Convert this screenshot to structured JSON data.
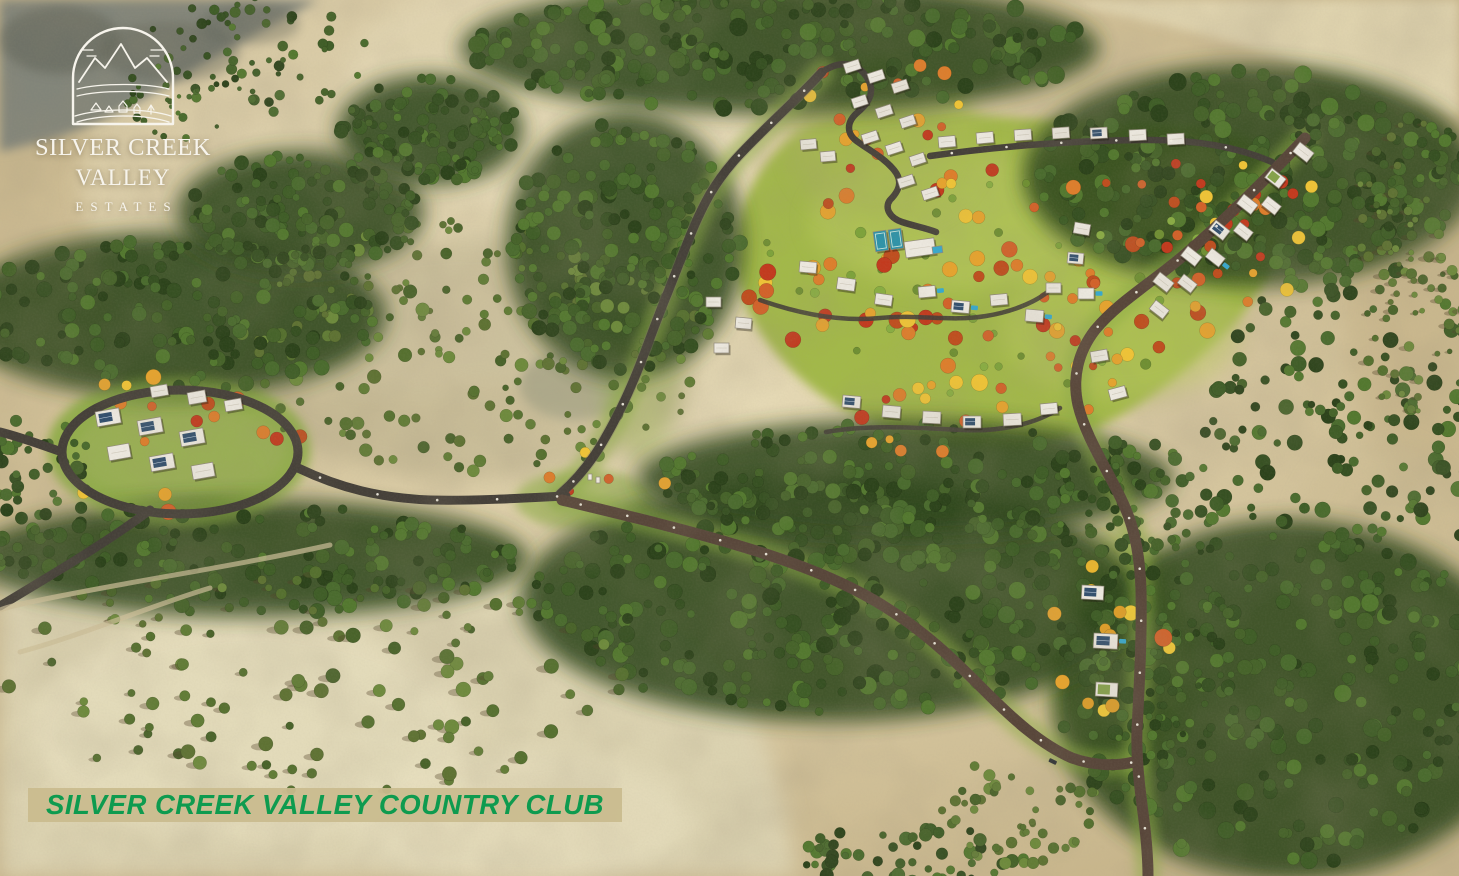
{
  "logo": {
    "line1": "SILVER CREEK",
    "line2": "VALLEY",
    "line3": "ESTATES",
    "emblem": "mountain-valley-arch-emblem"
  },
  "banner": {
    "text": "SILVER CREEK VALLEY COUNTRY CLUB"
  },
  "scene": {
    "description": "aerial-3d-render-of-hillside-masterplan-community",
    "palette": {
      "tan": "#c8b68c",
      "tanLight": "#dfd3ae",
      "tanPale": "#dbd2b0",
      "palePatch": "#e9e1c1",
      "rock": "#82857a",
      "rockDark": "#5d6054",
      "forestBlob": "#2f461d",
      "lawn": "#a2b84a",
      "lawnLight": "#b9c95e",
      "road": "#454039",
      "dirt": "#58463a",
      "verge": "#8cab45",
      "house": "#ece8df",
      "houseEdge": "#8f887a",
      "solar": "#33506e",
      "pool": "#38a8cc",
      "greenRoof": "#85a24b",
      "court": "#2f93a8",
      "bannerGreen": "#0e9b4f",
      "logoWhite": "#f7f4ec"
    },
    "tree_palettes": {
      "forest": [
        "#2c431b",
        "#365022",
        "#3f5d27",
        "#4a6b2e",
        "#53782f",
        "#46632a"
      ],
      "olive": [
        "#55702f",
        "#617c36",
        "#6d8a3c",
        "#49632a",
        "#5e7233"
      ],
      "autumn": [
        "#bf4e1f",
        "#d2622a",
        "#dd7e2c",
        "#e5a32f",
        "#eec337",
        "#c23a1e"
      ],
      "golden": [
        "#e8b52f",
        "#f0c838",
        "#dd9e2a",
        "#d2622a",
        "#e5a32f"
      ],
      "lawnshrub": [
        "#6f8f33",
        "#7da23b",
        "#88ad42"
      ]
    },
    "tree_regions": [
      {
        "name": "top-band",
        "cx": 780,
        "cy": 48,
        "rx": 310,
        "ry": 62,
        "count": 240,
        "pal": "forest",
        "rmin": 4,
        "rmax": 9,
        "blob": true,
        "seed": 11
      },
      {
        "name": "top-right",
        "cx": 1250,
        "cy": 175,
        "rx": 220,
        "ry": 105,
        "count": 270,
        "pal": "forest",
        "rmin": 4,
        "rmax": 9,
        "blob": true,
        "seed": 12
      },
      {
        "name": "right-mid",
        "cx": 1352,
        "cy": 430,
        "rx": 150,
        "ry": 170,
        "count": 170,
        "pal": "forest",
        "rmin": 3.5,
        "rmax": 8,
        "seed": 13
      },
      {
        "name": "right-low",
        "cx": 1290,
        "cy": 700,
        "rx": 230,
        "ry": 170,
        "count": 260,
        "pal": "forest",
        "rmin": 4,
        "rmax": 9,
        "blob": true,
        "seed": 14
      },
      {
        "name": "central-band",
        "cx": 830,
        "cy": 600,
        "rx": 300,
        "ry": 115,
        "count": 330,
        "pal": "forest",
        "rmin": 4,
        "rmax": 9,
        "blob": true,
        "seed": 15
      },
      {
        "name": "mid-slope",
        "cx": 470,
        "cy": 350,
        "rx": 240,
        "ry": 130,
        "count": 180,
        "pal": "olive",
        "rmin": 3,
        "rmax": 7,
        "seed": 16
      },
      {
        "name": "left-band",
        "cx": 170,
        "cy": 315,
        "rx": 210,
        "ry": 78,
        "count": 170,
        "pal": "forest",
        "rmin": 4,
        "rmax": 8,
        "blob": true,
        "seed": 17
      },
      {
        "name": "below-cluster",
        "cx": 250,
        "cy": 558,
        "rx": 270,
        "ry": 55,
        "count": 140,
        "pal": "forest",
        "rmin": 4,
        "rmax": 8,
        "blob": true,
        "seed": 18
      },
      {
        "name": "bottom-left-sparse",
        "cx": 300,
        "cy": 680,
        "rx": 330,
        "ry": 115,
        "count": 110,
        "pal": "olive",
        "rmin": 3.5,
        "rmax": 7.5,
        "shadow": true,
        "seed": 19
      },
      {
        "name": "hilltop-scatter",
        "cx": 255,
        "cy": 55,
        "rx": 115,
        "ry": 58,
        "count": 55,
        "pal": "forest",
        "rmin": 2.5,
        "rmax": 5.5,
        "seed": 20
      },
      {
        "name": "lawn-shrubs",
        "cx": 990,
        "cy": 280,
        "rx": 240,
        "ry": 125,
        "count": 40,
        "pal": "lawnshrub",
        "rmin": 3,
        "rmax": 6,
        "seed": 21
      },
      {
        "name": "right-edge-sparse",
        "cx": 1408,
        "cy": 268,
        "rx": 58,
        "ry": 150,
        "count": 70,
        "pal": "olive",
        "rmin": 2.5,
        "rmax": 5.5,
        "shadow": true,
        "seed": 22
      },
      {
        "name": "near-lawn-band",
        "cx": 905,
        "cy": 478,
        "rx": 260,
        "ry": 55,
        "count": 140,
        "pal": "forest",
        "rmin": 4,
        "rmax": 8,
        "blob": true,
        "seed": 23
      },
      {
        "name": "west-road-forest",
        "cx": 625,
        "cy": 245,
        "rx": 115,
        "ry": 125,
        "count": 190,
        "pal": "forest",
        "rmin": 4,
        "rmax": 8,
        "blob": true,
        "seed": 24
      },
      {
        "name": "bottom-mid-strip",
        "cx": 910,
        "cy": 858,
        "rx": 115,
        "ry": 32,
        "count": 60,
        "pal": "forest",
        "rmin": 3.5,
        "rmax": 7,
        "seed": 25
      },
      {
        "name": "se-corridor",
        "cx": 1165,
        "cy": 650,
        "rx": 80,
        "ry": 120,
        "count": 80,
        "pal": "forest",
        "rmin": 3,
        "rmax": 6,
        "seed": 26
      },
      {
        "name": "diag-band-1",
        "cx": 300,
        "cy": 212,
        "rx": 120,
        "ry": 58,
        "count": 130,
        "pal": "forest",
        "rmin": 3.5,
        "rmax": 7.5,
        "blob": true,
        "seed": 27
      },
      {
        "name": "diag-band-2",
        "cx": 430,
        "cy": 130,
        "rx": 90,
        "ry": 52,
        "count": 110,
        "pal": "forest",
        "rmin": 3.5,
        "rmax": 7.5,
        "blob": true,
        "seed": 28
      },
      {
        "name": "rock-edge",
        "cx": 185,
        "cy": 95,
        "rx": 62,
        "ry": 45,
        "count": 30,
        "pal": "forest",
        "rmin": 2,
        "rmax": 4.5,
        "seed": 29
      },
      {
        "name": "right-of-lawn",
        "cx": 1130,
        "cy": 500,
        "rx": 90,
        "ry": 60,
        "count": 70,
        "pal": "forest",
        "rmin": 3.5,
        "rmax": 7,
        "seed": 30
      },
      {
        "name": "bottom-gap",
        "cx": 1020,
        "cy": 810,
        "rx": 80,
        "ry": 55,
        "count": 50,
        "pal": "olive",
        "rmin": 3,
        "rmax": 6,
        "seed": 31
      },
      {
        "name": "left-edge-low",
        "cx": 40,
        "cy": 500,
        "rx": 60,
        "ry": 90,
        "count": 50,
        "pal": "forest",
        "rmin": 3.5,
        "rmax": 7,
        "seed": 32
      }
    ],
    "autumn_regions": [
      {
        "name": "left-cluster",
        "cx": 170,
        "cy": 442,
        "rx": 135,
        "ry": 70,
        "count": 16,
        "pal": "autumn",
        "rmin": 4.5,
        "rmax": 8.5,
        "seed": 41
      },
      {
        "name": "top-cluster",
        "cx": 878,
        "cy": 130,
        "rx": 95,
        "ry": 80,
        "count": 18,
        "pal": "autumn",
        "rmin": 4,
        "rmax": 7.5,
        "seed": 42
      },
      {
        "name": "lawn-dots",
        "cx": 990,
        "cy": 285,
        "rx": 245,
        "ry": 120,
        "count": 48,
        "pal": "autumn",
        "rmin": 4.5,
        "rmax": 8.5,
        "seed": 43
      },
      {
        "name": "right-street",
        "cx": 1200,
        "cy": 230,
        "rx": 130,
        "ry": 95,
        "count": 22,
        "pal": "autumn",
        "rmin": 4,
        "rmax": 7,
        "seed": 44
      },
      {
        "name": "mid-cluster",
        "cx": 910,
        "cy": 300,
        "rx": 120,
        "ry": 55,
        "count": 15,
        "pal": "autumn",
        "rmin": 4.5,
        "rmax": 8.5,
        "seed": 45
      },
      {
        "name": "se-corridor",
        "cx": 1105,
        "cy": 640,
        "rx": 65,
        "ry": 105,
        "count": 14,
        "pal": "golden",
        "rmin": 5,
        "rmax": 9,
        "seed": 46
      },
      {
        "name": "junction",
        "cx": 600,
        "cy": 482,
        "rx": 65,
        "ry": 35,
        "count": 6,
        "pal": "autumn",
        "rmin": 3.5,
        "rmax": 6.5,
        "seed": 47
      },
      {
        "name": "bottom-lawn",
        "cx": 945,
        "cy": 418,
        "rx": 110,
        "ry": 42,
        "count": 11,
        "pal": "autumn",
        "rmin": 4,
        "rmax": 7.5,
        "seed": 48
      },
      {
        "name": "right-tail",
        "cx": 1090,
        "cy": 350,
        "rx": 55,
        "ry": 70,
        "count": 10,
        "pal": "autumn",
        "rmin": 4,
        "rmax": 7,
        "seed": 49
      },
      {
        "name": "lawn-east",
        "cx": 1255,
        "cy": 210,
        "rx": 60,
        "ry": 70,
        "count": 10,
        "pal": "autumn",
        "rmin": 4,
        "rmax": 7,
        "seed": 50
      }
    ],
    "houses": [
      [
        95,
        412,
        24,
        15,
        -10,
        "solar"
      ],
      [
        137,
        421,
        24,
        15,
        -10,
        "solar"
      ],
      [
        179,
        432,
        24,
        15,
        -10,
        "solar"
      ],
      [
        107,
        447,
        22,
        14,
        -10,
        "white"
      ],
      [
        149,
        457,
        24,
        15,
        -10,
        "solar"
      ],
      [
        191,
        466,
        22,
        14,
        -10,
        "white"
      ],
      [
        150,
        387,
        17,
        11,
        -10,
        "white"
      ],
      [
        187,
        393,
        18,
        12,
        -10,
        "white"
      ],
      [
        224,
        401,
        17,
        11,
        -10,
        "white"
      ],
      [
        843,
        64,
        16,
        10,
        -18,
        "white"
      ],
      [
        867,
        74,
        16,
        10,
        -18,
        "white"
      ],
      [
        891,
        84,
        16,
        10,
        -18,
        "white"
      ],
      [
        851,
        99,
        15,
        10,
        -18,
        "white"
      ],
      [
        875,
        109,
        16,
        10,
        -18,
        "white"
      ],
      [
        899,
        119,
        15,
        10,
        -18,
        "white"
      ],
      [
        861,
        135,
        16,
        10,
        -18,
        "white"
      ],
      [
        885,
        146,
        16,
        10,
        -18,
        "white"
      ],
      [
        909,
        157,
        15,
        10,
        -18,
        "white"
      ],
      [
        897,
        179,
        16,
        10,
        -18,
        "white"
      ],
      [
        921,
        191,
        16,
        10,
        -18,
        "white"
      ],
      [
        800,
        140,
        16,
        10,
        -5,
        "white"
      ],
      [
        820,
        152,
        15,
        10,
        -5,
        "white"
      ],
      [
        938,
        137,
        17,
        11,
        -5,
        "white"
      ],
      [
        976,
        133,
        17,
        11,
        -5,
        "white"
      ],
      [
        1014,
        130,
        17,
        11,
        -4,
        "white"
      ],
      [
        1052,
        128,
        17,
        11,
        -4,
        "white"
      ],
      [
        1090,
        128,
        17,
        11,
        -3,
        "solar"
      ],
      [
        1129,
        130,
        17,
        11,
        -3,
        "white"
      ],
      [
        1167,
        134,
        17,
        11,
        -3,
        "white"
      ],
      [
        1300,
        142,
        18,
        12,
        38,
        "white"
      ],
      [
        1272,
        168,
        18,
        12,
        38,
        "green"
      ],
      [
        1244,
        194,
        18,
        12,
        38,
        "white"
      ],
      [
        1216,
        220,
        18,
        12,
        38,
        "solar"
      ],
      [
        1188,
        246,
        18,
        12,
        38,
        "white"
      ],
      [
        1160,
        272,
        18,
        12,
        38,
        "white"
      ],
      [
        1268,
        196,
        17,
        11,
        38,
        "white"
      ],
      [
        1240,
        222,
        17,
        11,
        38,
        "white"
      ],
      [
        1212,
        248,
        17,
        11,
        38,
        "pool"
      ],
      [
        1184,
        274,
        17,
        11,
        38,
        "white"
      ],
      [
        1156,
        300,
        17,
        11,
        38,
        "white"
      ],
      [
        1075,
        222,
        16,
        11,
        10,
        "white"
      ],
      [
        1068,
        252,
        16,
        11,
        5,
        "solar"
      ],
      [
        1078,
        288,
        16,
        11,
        0,
        "pool"
      ],
      [
        1090,
        352,
        17,
        11,
        -10,
        "white"
      ],
      [
        1108,
        390,
        17,
        11,
        -15,
        "white"
      ],
      [
        800,
        261,
        17,
        11,
        5,
        "white"
      ],
      [
        838,
        277,
        18,
        12,
        8,
        "white"
      ],
      [
        876,
        293,
        17,
        11,
        8,
        "white"
      ],
      [
        918,
        287,
        17,
        11,
        -5,
        "pool"
      ],
      [
        952,
        300,
        18,
        12,
        5,
        "poolsolar"
      ],
      [
        990,
        295,
        17,
        11,
        -5,
        "white"
      ],
      [
        1026,
        309,
        18,
        12,
        5,
        "pool"
      ],
      [
        1046,
        283,
        15,
        10,
        0,
        "white"
      ],
      [
        873,
        232,
        13,
        20,
        -8,
        "court"
      ],
      [
        888,
        230,
        13,
        20,
        -8,
        "court"
      ],
      [
        904,
        242,
        30,
        16,
        -8,
        "white"
      ],
      [
        932,
        247,
        10,
        7,
        -8,
        "water"
      ],
      [
        706,
        297,
        15,
        10,
        0,
        "white"
      ],
      [
        736,
        317,
        16,
        11,
        5,
        "white"
      ],
      [
        714,
        343,
        15,
        10,
        0,
        "white"
      ],
      [
        843,
        395,
        18,
        12,
        5,
        "solar"
      ],
      [
        883,
        405,
        18,
        12,
        5,
        "white"
      ],
      [
        923,
        411,
        18,
        12,
        3,
        "white"
      ],
      [
        963,
        416,
        18,
        12,
        0,
        "solar"
      ],
      [
        1003,
        414,
        18,
        12,
        -3,
        "white"
      ],
      [
        1040,
        404,
        17,
        11,
        -5,
        "white"
      ],
      [
        1082,
        585,
        22,
        14,
        3,
        "solar"
      ],
      [
        1094,
        633,
        24,
        15,
        3,
        "poolsolar"
      ],
      [
        1096,
        682,
        22,
        14,
        3,
        "green"
      ],
      [
        588,
        474,
        4,
        6,
        0,
        "gate"
      ],
      [
        596,
        477,
        4,
        6,
        0,
        "gate"
      ]
    ],
    "car": {
      "x": 1050,
      "y": 758,
      "w": 8,
      "h": 4,
      "rot": 25,
      "color": "#2e3236"
    },
    "light_roads": [
      {
        "id": "r2",
        "gap": 46
      },
      {
        "id": "r4",
        "gap": 52
      },
      {
        "id": "r5",
        "gap": 48
      },
      {
        "id": "r1c",
        "gap": 60
      },
      {
        "id": "r3",
        "gap": 55
      }
    ]
  }
}
